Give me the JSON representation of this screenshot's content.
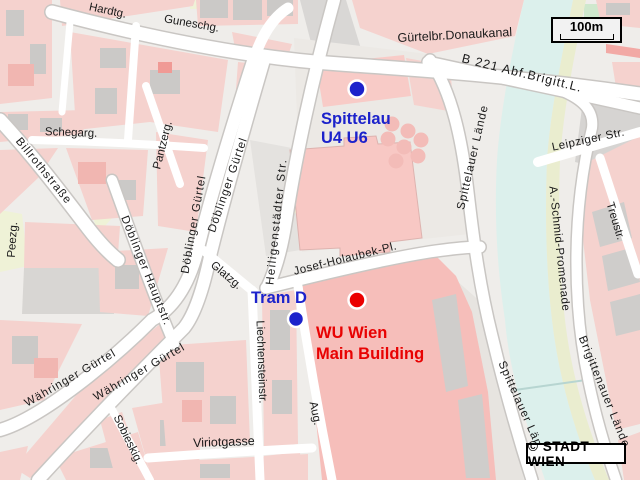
{
  "map": {
    "title": "Stadtplan Wien - Spittelau / WU Wien",
    "copyright": "© STADT WIEN",
    "scale_label": "100m",
    "colors": {
      "background": "#EFEDEA",
      "block_pink": "#F5D2CE",
      "building_pink": "#F1B6B1",
      "building_gray": "#CBC9C7",
      "campus_pink": "#F6BEBA",
      "open_gray": "#ECE9E5",
      "rail_gray": "#D8D6D3",
      "street_white": "#FFFFFF",
      "street_casing": "#C9C6C3",
      "water_cyan": "#DCF0EC",
      "park_green": "#EFF2D7",
      "promenade_yellow": "#EAEDCF",
      "label_black": "#1a1a1a",
      "transit_blue": "#1C22CB",
      "poi_red": "#E80202"
    },
    "markers": [
      {
        "id": "spittelau-station",
        "kind": "u-bahn-station",
        "color": "#1C22CB",
        "text_color": "#1C22CB",
        "dot": {
          "x": 357,
          "y": 89,
          "r": 8.5
        },
        "lines": [
          {
            "text": "Spittelau",
            "x": 321,
            "y": 124
          },
          {
            "text": "U4 U6",
            "x": 321,
            "y": 143
          }
        ]
      },
      {
        "id": "tram-d-stop",
        "kind": "tram-stop",
        "color": "#1C22CB",
        "text_color": "#1C22CB",
        "dot": {
          "x": 296,
          "y": 319,
          "r": 8
        },
        "lines": [
          {
            "text": "Tram D",
            "x": 251,
            "y": 303
          }
        ]
      },
      {
        "id": "wu-wien",
        "kind": "poi",
        "color": "#EB0000",
        "text_color": "#E80202",
        "dot": {
          "x": 357,
          "y": 300,
          "r": 8.5
        },
        "lines": [
          {
            "text": "WU Wien",
            "x": 316,
            "y": 338
          },
          {
            "text": "Main Building",
            "x": 316,
            "y": 359
          }
        ]
      }
    ],
    "street_labels": [
      {
        "text": "Hardtg.",
        "x": 107,
        "y": 14,
        "rot": 12
      },
      {
        "text": "Guneschg.",
        "x": 191,
        "y": 27,
        "rot": 10
      },
      {
        "text": "Gürtelbr.Donaukanal",
        "x": 455,
        "y": 39,
        "rot": -3,
        "fs": 12.5
      },
      {
        "text": "B 221 Abf.Brigitt.L.",
        "x": 521,
        "y": 77,
        "rot": 14,
        "fs": 12.5,
        "ls": 1
      },
      {
        "text": "Schegarg.",
        "x": 71,
        "y": 136,
        "rot": 2
      },
      {
        "text": "Billrothstraße",
        "x": 41,
        "y": 173,
        "rot": 51,
        "ls": 1
      },
      {
        "text": "Pantzerg.",
        "x": 166,
        "y": 146,
        "rot": -76
      },
      {
        "text": "Döblinger Gürtel",
        "x": 197,
        "y": 225,
        "rot": -80,
        "ls": 1
      },
      {
        "text": "Döblinger Gürtel",
        "x": 231,
        "y": 186,
        "rot": -71,
        "ls": 1
      },
      {
        "text": "Heiligenstädter Str.",
        "x": 280,
        "y": 222,
        "rot": -84,
        "ls": 1.5
      },
      {
        "text": "Döblinger Hauptstr.",
        "x": 143,
        "y": 272,
        "rot": 68,
        "ls": 1
      },
      {
        "text": "Peezg.",
        "x": 16,
        "y": 240,
        "rot": -86
      },
      {
        "text": "Glatzg.",
        "x": 224,
        "y": 278,
        "rot": 40
      },
      {
        "text": "Josef-Holaubek-Pl.",
        "x": 346,
        "y": 262,
        "rot": -14,
        "ls": 0.5
      },
      {
        "text": "Liechtensteinstr.",
        "x": 258,
        "y": 362,
        "rot": 88
      },
      {
        "text": "Währinger Gürtel",
        "x": 72,
        "y": 381,
        "rot": -30,
        "ls": 1
      },
      {
        "text": "Währinger Gürtel",
        "x": 141,
        "y": 375,
        "rot": -30,
        "ls": 1
      },
      {
        "text": "Sobieskig.",
        "x": 125,
        "y": 441,
        "rot": 64
      },
      {
        "text": "Viriotgasse",
        "x": 224,
        "y": 446,
        "rot": -2,
        "fs": 12.5
      },
      {
        "text": "Aug.",
        "x": 312,
        "y": 414,
        "rot": 78
      },
      {
        "text": "Spittelauer Lände",
        "x": 476,
        "y": 158,
        "rot": -77,
        "ls": 1
      },
      {
        "text": "Spittelauer Lände",
        "x": 520,
        "y": 412,
        "rot": 66,
        "ls": 1
      },
      {
        "text": "Leipziger Str.",
        "x": 589,
        "y": 143,
        "rot": -12,
        "ls": 0.5
      },
      {
        "text": "Treustr.",
        "x": 612,
        "y": 222,
        "rot": 73
      },
      {
        "text": "A.-Schmid-Promenade",
        "x": 556,
        "y": 249,
        "rot": 84,
        "ls": 0.5
      },
      {
        "text": "Brigittenauer Lände",
        "x": 601,
        "y": 393,
        "rot": 68,
        "ls": 1
      }
    ]
  }
}
